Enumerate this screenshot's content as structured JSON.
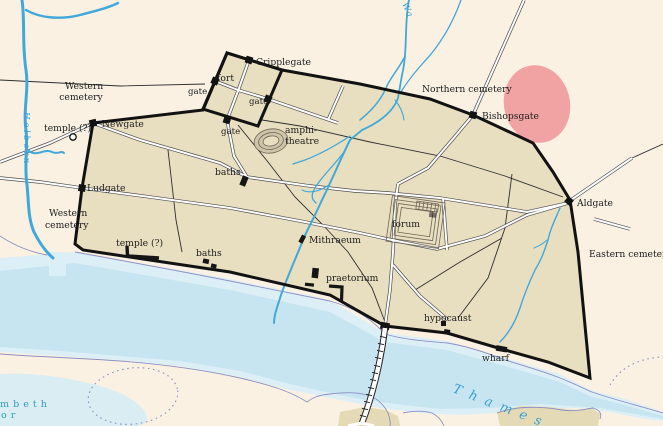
{
  "map": {
    "region_labels": {
      "western_cemetery_north_line1": "Western",
      "western_cemetery_north_line2": "cemetery",
      "western_cemetery_south_line1": "Western",
      "western_cemetery_south_line2": "cemetery",
      "northern_cemetery": "Northern cemetery",
      "eastern_cemetery": "Eastern cemetery"
    },
    "gate_labels": {
      "newgate": "Newgate",
      "ludgate": "Ludgate",
      "cripplegate": "Cripplegate",
      "bishopsgate": "Bishopsgate",
      "aldgate": "Aldgate",
      "fort_gate_west": "gate",
      "fort_gate_east": "gate",
      "fort_gate_south": "gate"
    },
    "site_labels": {
      "fort": "fort",
      "amphitheatre_line1": "amphi-",
      "amphitheatre_line2": "theatre",
      "baths_north": "baths",
      "baths_south": "baths",
      "temple_west": "temple (?)",
      "temple_south": "temple (?)",
      "forum": "forum",
      "mithraeum": "Mithraeum",
      "praetorium": "praetorium",
      "hypocaust": "hypocaust",
      "wharf": "wharf"
    },
    "water_labels": {
      "thames": "Thames",
      "holborn": "Holborn",
      "walbrook_partial": "Wa",
      "lambeth_line1": "mbeth",
      "lambeth_line2": "or"
    },
    "colors": {
      "background": "#faf1e3",
      "city_fill": "#e8dec0",
      "wall": "#121212",
      "river_channel": "#c7e5f1",
      "river_shore": "#dceff6",
      "stream": "#41a8da",
      "road_casing": "#4d4d4d",
      "cemetery_area": "#f1a2a2",
      "water_label": "#389fd2",
      "lambeth_label": "#2f9dba",
      "boundary": "#8d90c4",
      "island_fill": "#e4dab6",
      "marsh": "#daedf3",
      "text_color": "#1c1c1c"
    }
  }
}
